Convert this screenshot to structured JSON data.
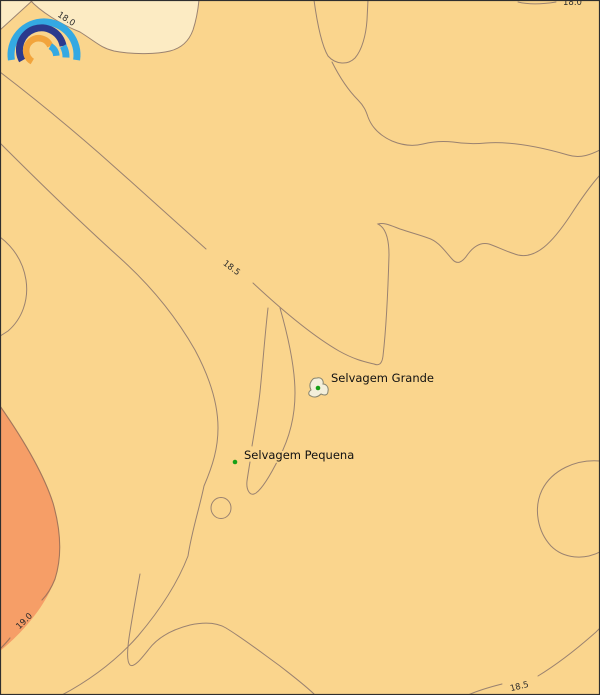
{
  "map": {
    "type": "isotherm-contour-map",
    "background_color": "#FAD58D",
    "frame_color": "#2e2e2e",
    "contour_line_color": "#9A8270",
    "band_colors": {
      "cooler_band": "#FCEBC3",
      "middle_band": "#FAD58D",
      "warmer_band": "#F69E67"
    },
    "contour_labels": {
      "top_left_18_0": "18.0",
      "top_right_18_0": "18.0",
      "mid_18_5": "18.5",
      "bottom_right_18_5": "18.5",
      "bottom_left_19_0": "19.0"
    },
    "places": {
      "selvagem_grande": "Selvagem Grande",
      "selvagem_pequena": "Selvagem Pequena"
    },
    "marker_color": "#17A017",
    "island_fill": "#F3EFDB"
  },
  "logo": {
    "name": "rainbow-arcs-logo",
    "arc_colors": [
      "#34A9E2",
      "#2B3A8D",
      "#F2A43C"
    ]
  }
}
